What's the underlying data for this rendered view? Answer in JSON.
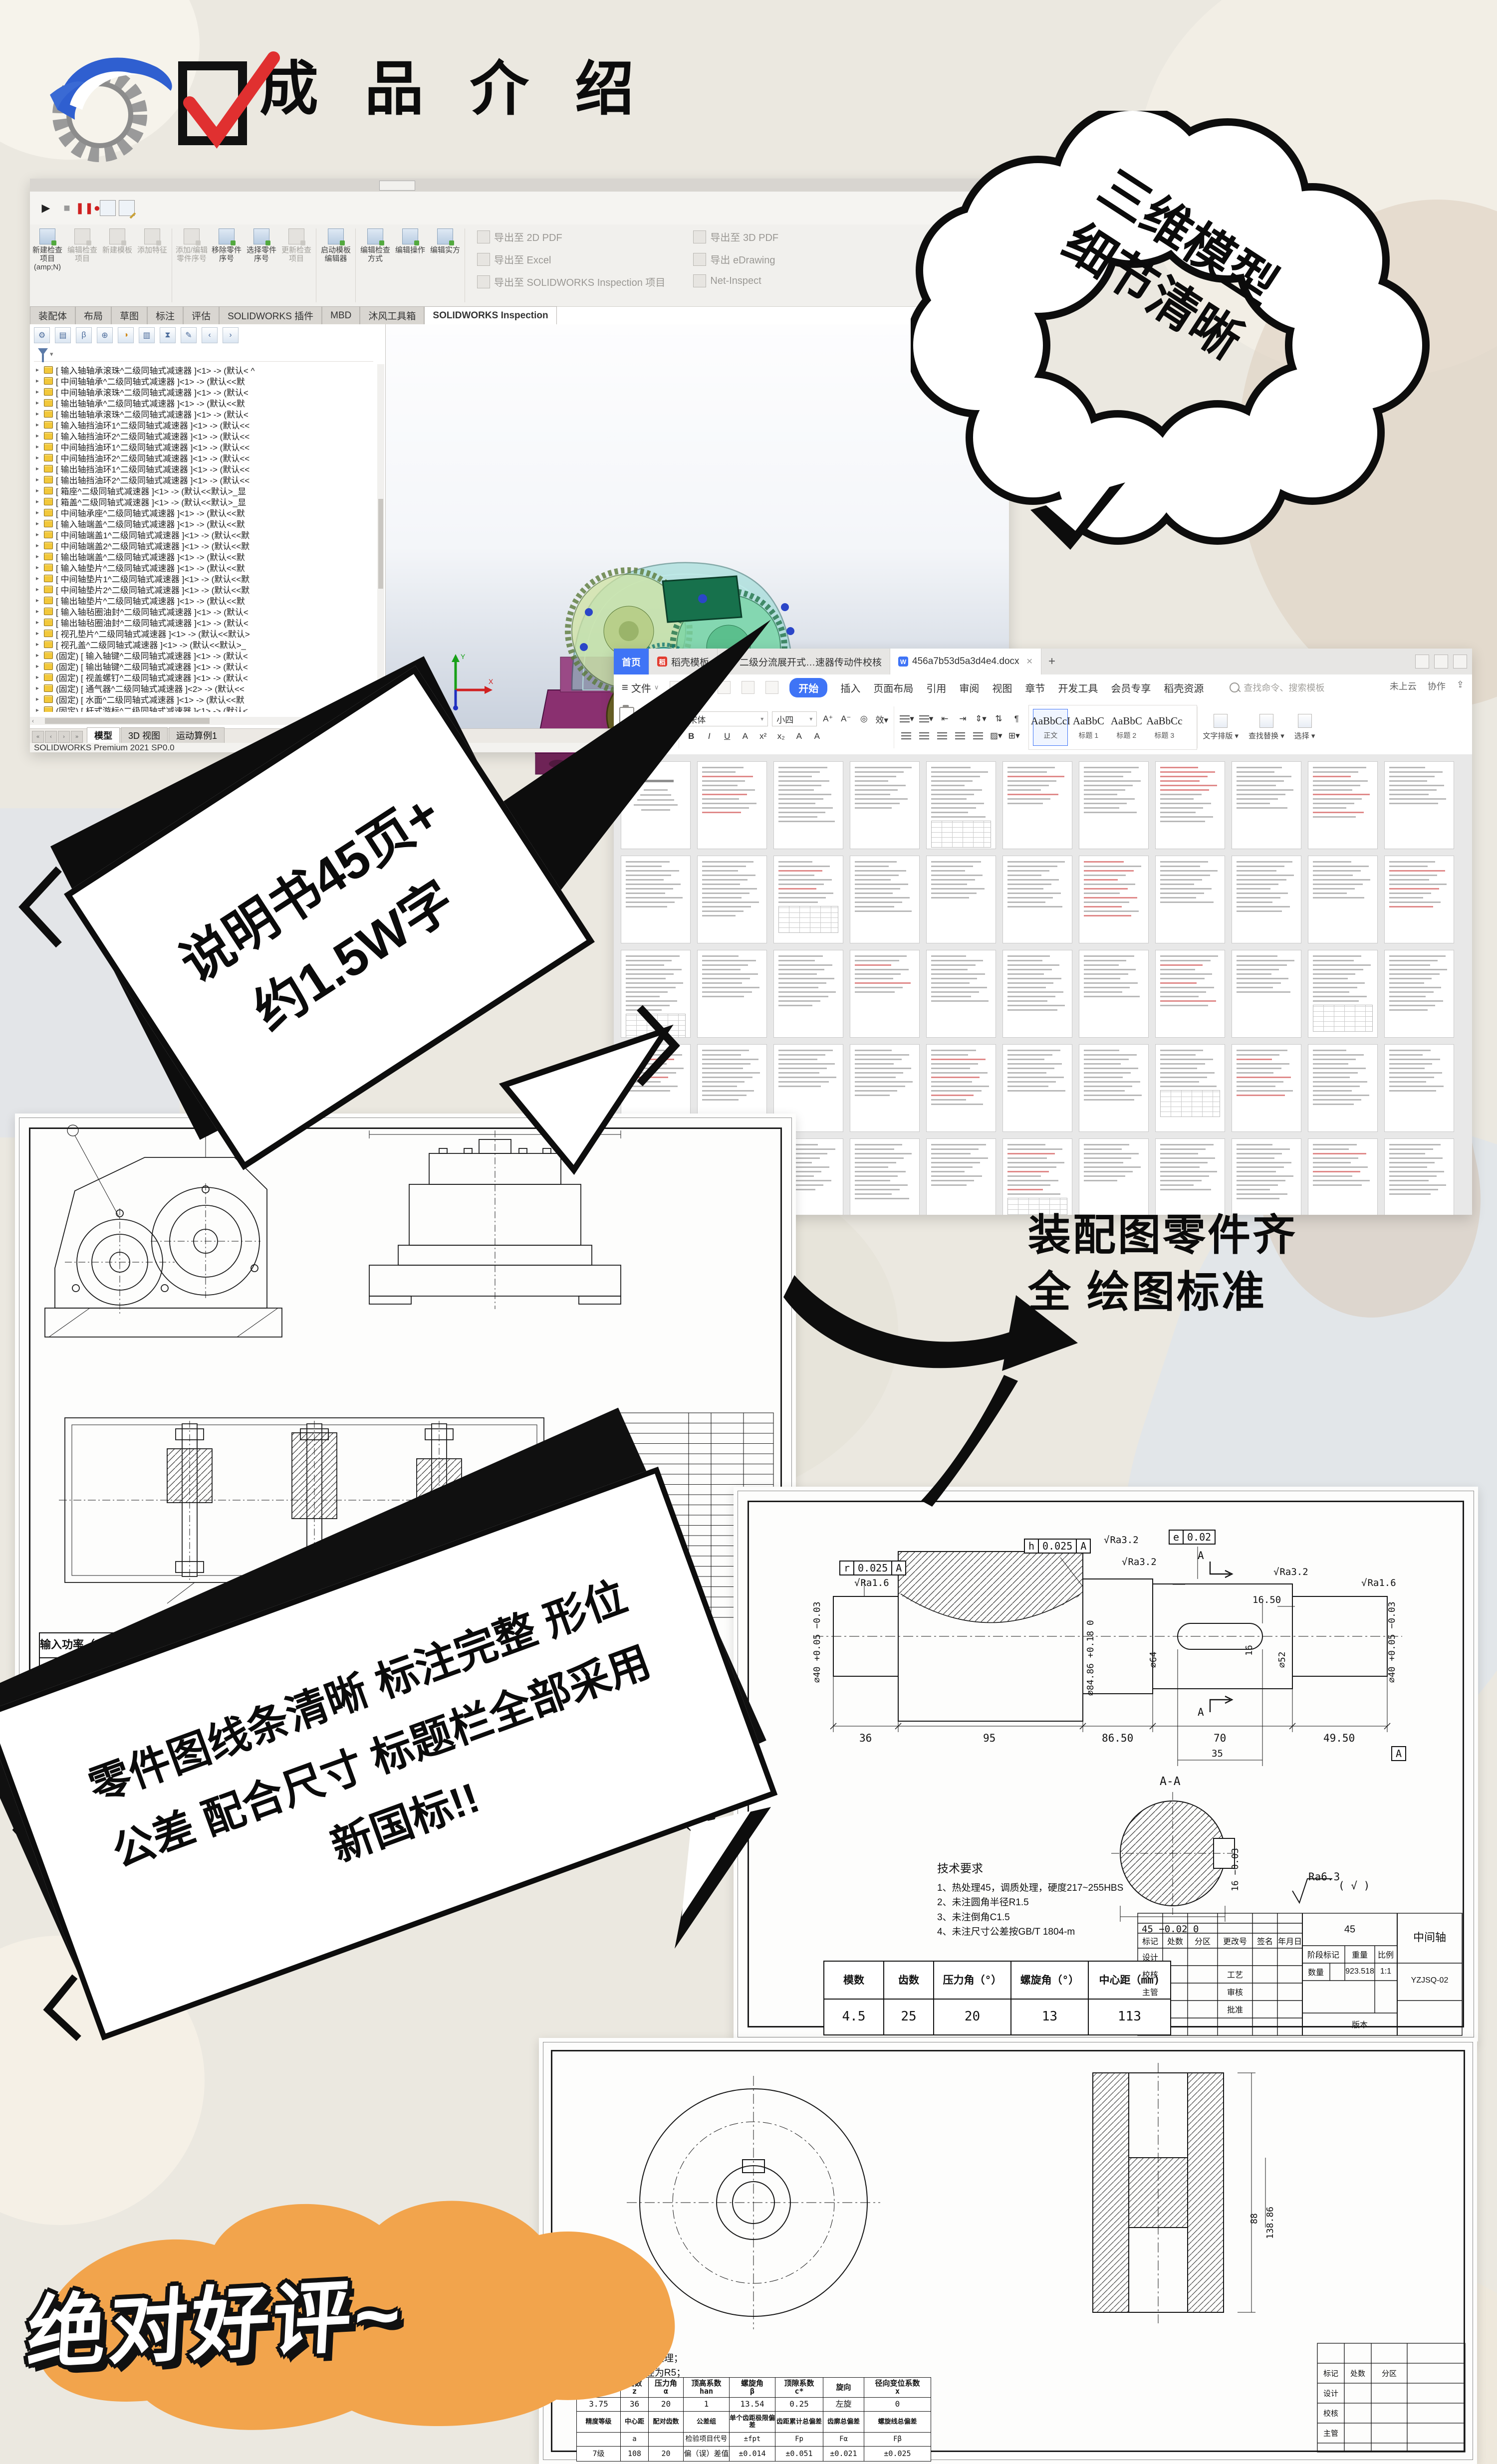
{
  "header": {
    "title": "成 品 介 绍",
    "logo_icon": "gear-swoosh-logo",
    "check_icon": "red-checkbox"
  },
  "callouts": {
    "cloud_line1": "三维模型",
    "cloud_line2": "细节清晰",
    "manual_line1": "说明书45页+",
    "manual_line2": "约1.5W字",
    "assembly_line1": "装配图零件齐",
    "assembly_line2": "全 绘图标准",
    "banner_line1": "零件图线条清晰 标注完整 形位",
    "banner_line2": "公差 配合尺寸 标题栏全部采用",
    "banner_line3": "新国标!!",
    "review": "绝对好评~",
    "accent_orange": "#f2a44c",
    "outline_black": "#0d0d0d"
  },
  "solidworks": {
    "ribbon_buttons": [
      "新建检查项目 (amp;N)",
      "编辑检查项目",
      "新建模板",
      "添加特征",
      "添加/编辑零件序号",
      "移除零件序号",
      "选择零件序号",
      "更新检查项目",
      "启动模板编辑器",
      "编辑检查方式",
      "编辑操作",
      "编辑实方"
    ],
    "disabled_buttons": [
      1,
      2,
      3,
      4,
      7
    ],
    "export_buttons": [
      "导出至 2D PDF",
      "导出至 Excel",
      "导出至 SOLIDWORKS Inspection 项目",
      "导出至 3D PDF",
      "导出 eDrawing",
      "Net-Inspect"
    ],
    "tabs": [
      "装配体",
      "布局",
      "草图",
      "标注",
      "评估",
      "SOLIDWORKS 插件",
      "MBD",
      "沐风工具箱",
      "SOLIDWORKS Inspection"
    ],
    "active_tab_index": 8,
    "tree_items": [
      "[ 输入轴轴承滚珠^二级同轴式减速器 ]<1> -> (默认<  ^",
      "[ 中间轴轴承^二级同轴式减速器 ]<1> -> (默认<<默",
      "[ 中间轴轴承滚珠^二级同轴式减速器 ]<1> -> (默认<",
      "[ 输出轴轴承^二级同轴式减速器 ]<1> -> (默认<<默",
      "[ 输出轴轴承滚珠^二级同轴式减速器 ]<1> -> (默认<",
      "[ 输入轴挡油环1^二级同轴式减速器 ]<1> -> (默认<<",
      "[ 输入轴挡油环2^二级同轴式减速器 ]<1> -> (默认<<",
      "[ 中间轴挡油环1^二级同轴式减速器 ]<1> -> (默认<<",
      "[ 中间轴挡油环2^二级同轴式减速器 ]<1> -> (默认<<",
      "[ 输出轴挡油环1^二级同轴式减速器 ]<1> -> (默认<<",
      "[ 输出轴挡油环2^二级同轴式减速器 ]<1> -> (默认<<",
      "[ 箱座^二级同轴式减速器 ]<1> -> (默认<<默认>_显",
      "[ 箱盖^二级同轴式减速器 ]<1> -> (默认<<默认>_显",
      "[ 中间轴承座^二级同轴式减速器 ]<1> -> (默认<<默",
      "[ 输入轴端盖^二级同轴式减速器 ]<1> -> (默认<<默",
      "[ 中间轴端盖1^二级同轴式减速器 ]<1> -> (默认<<默",
      "[ 中间轴端盖2^二级同轴式减速器 ]<1> -> (默认<<默",
      "[ 输出轴端盖^二级同轴式减速器 ]<1> -> (默认<<默",
      "[ 输入轴垫片^二级同轴式减速器 ]<1> -> (默认<<默",
      "[ 中间轴垫片1^二级同轴式减速器 ]<1> -> (默认<<默",
      "[ 中间轴垫片2^二级同轴式减速器 ]<1> -> (默认<<默",
      "[ 输出轴垫片^二级同轴式减速器 ]<1> -> (默认<<默",
      "[ 输入轴毡圈油封^二级同轴式减速器 ]<1> -> (默认<",
      "[ 输出轴毡圈油封^二级同轴式减速器 ]<1> -> (默认<",
      "[ 视孔垫片^二级同轴式减速器 ]<1> -> (默认<<默认>",
      "[ 视孔盖^二级同轴式减速器 ]<1> -> (默认<<默认>_",
      "(固定) [ 输入轴键^二级同轴式减速器 ]<1> -> (默认<",
      "(固定) [ 输出轴键^二级同轴式减速器 ]<1> -> (默认<",
      "(固定) [ 视盖螺钉^二级同轴式减速器 ]<1> -> (默认<",
      "(固定) [ 通气器^二级同轴式减速器 ]<2> -> (默认<<",
      "(固定) [ 水面^二级同轴式减速器 ]<1> -> (默认<<默",
      "(固定) [ 杆式游标^二级同轴式减速器 ]<1> -> (默认<",
      "(固定) [ 油圈^二级同轴式减速器 ]<1> -> (默认<<默"
    ],
    "bottom_tabs": [
      "模型",
      "3D 视图",
      "运动算例1"
    ],
    "active_bottom_tab_index": 0,
    "status": "SOLIDWORKS Premium 2021 SP0.0"
  },
  "wps": {
    "window_tabs": [
      {
        "label": "首页",
        "type": "home"
      },
      {
        "label": "稻壳模板",
        "type": "doc",
        "icon_color": "#e23c30",
        "icon_text": "稻"
      },
      {
        "label": "二级分流展开式…速器传动件校核",
        "type": "doc",
        "icon_color": "#ef7b1a",
        "icon_text": "P"
      },
      {
        "label": "456a7b53d5a3d4e4.docx",
        "type": "active",
        "icon_color": "#3f74f6",
        "icon_text": "W"
      }
    ],
    "new_tab": "+",
    "file_menu": "文件",
    "menus": [
      "开始",
      "插入",
      "页面布局",
      "引用",
      "审阅",
      "视图",
      "章节",
      "开发工具",
      "会员专享",
      "稻壳资源"
    ],
    "active_menu_index": 0,
    "search_placeholder": "查找命令、搜索模板",
    "cloud_status": "未上云",
    "collab": "协作",
    "clipboard": [
      "粘贴",
      "剪切",
      "复制",
      "格式刷"
    ],
    "font_name": "宋体",
    "font_size": "小四",
    "format_buttons": [
      "B",
      "I",
      "U",
      "A",
      "x²",
      "x₂",
      "A",
      "A"
    ],
    "styles": [
      {
        "sample": "AaBbCcI",
        "name": "正文"
      },
      {
        "sample": "AaBbC",
        "name": "标题 1"
      },
      {
        "sample": "AaBbC",
        "name": "标题 2"
      },
      {
        "sample": "AaBbCc",
        "name": "标题 3"
      }
    ],
    "tools": [
      "文字排版",
      "查找替换",
      "选择"
    ],
    "page_count_visible": 55
  },
  "assembly_sheet": {
    "tech_title": "技术要求",
    "spec_headers": [
      "输入功率（KW）",
      "输入转速（r/min)",
      "传动比"
    ],
    "spec_values": [
      "2.85",
      "177.5",
      "1.8"
    ],
    "detail_dim": "⌀30r6"
  },
  "shaft_sheet": {
    "gdt1": [
      "r",
      "0.025",
      "A"
    ],
    "gdt2": [
      "h",
      "0.025",
      "A"
    ],
    "gdt3": [
      "e",
      "0.02"
    ],
    "ra_left": "Ra1.6",
    "ra_mid1": "Ra3.2",
    "ra_mid2": "Ra3.2",
    "ra_mid3": "Ra3.2",
    "ra_right": "Ra1.6",
    "datum": "A",
    "len_dims": [
      "36",
      "95",
      "86.50",
      "70",
      "49.50"
    ],
    "dia_left": "⌀40 +0.05 −0.03",
    "dia_gear": "⌀84.86 +0.18 0",
    "dia_mid": "⌀64",
    "dia_key": "⌀52",
    "dia_right": "⌀40 +0.05 −0.03",
    "key_len": "16.50",
    "key_w": "16",
    "key_pos": "35",
    "section_label": "A-A",
    "section_dim_w": "45 −0.02 0",
    "section_dim_h": "16 −0.03",
    "finish_note": "Ra6.3",
    "finish_check": "( √ )",
    "tech": [
      "技术要求",
      "1、热处理45，调质处理，硬度217~255HBS",
      "2、未注圆角半径R1.5",
      "3、未注倒角C1.5",
      "4、未注尺寸公差按GB/T 1804-m"
    ],
    "param_headers": [
      "模数",
      "齿数",
      "压力角（°）",
      "螺旋角（°）",
      "中心距（mm)"
    ],
    "param_values": [
      "4.5",
      "25",
      "20",
      "13",
      "113"
    ],
    "title_block": {
      "row_labels": [
        "标记",
        "处数",
        "分区",
        "更改号",
        "签名",
        "年月日"
      ],
      "left_labels": [
        "设计",
        "校核",
        "主管"
      ],
      "mid_labels": [
        "工艺",
        "审核",
        "批准"
      ],
      "stage": "阶段标记",
      "weight": "重量",
      "scale": "比例",
      "qty": "数量",
      "version": "版本",
      "material": "45",
      "weight_val": "923.518",
      "scale_val": "1:1",
      "name": "中间轴",
      "code": "YZJSQ-02"
    }
  },
  "gear_sheet": {
    "tech": [
      "技术要求",
      "1.热处理，调质处理；",
      "2.未注圆角半径为R5；",
      "3.未注倒角为C2；",
      "4.清除毛刺。"
    ],
    "table_headers": [
      "法向模数\nm",
      "齿数\nz",
      "压力角\nα",
      "顶高系数\nhan",
      "螺旋角\nβ",
      "顶隙系数\nc*",
      "旋向",
      "径向变位系数\nx"
    ],
    "table_values": [
      "3.75",
      "36",
      "20",
      "1",
      "13.54",
      "0.25",
      "左旋",
      "0"
    ],
    "table2_headers": [
      "精度等级",
      "中心距",
      "配对齿数",
      "公差组",
      "单个齿距极限偏差",
      "齿距累计总偏差",
      "齿廓总偏差",
      "螺旋线总偏差"
    ],
    "table2_sub": [
      "",
      "a",
      "",
      "检验项目代号",
      "±fpt",
      "Fp",
      "Fα",
      "Fβ"
    ],
    "table2_values": [
      "7级",
      "108",
      "20",
      "偏（误）差值",
      "±0.014",
      "±0.051",
      "±0.021",
      "±0.025"
    ],
    "dim_a": "88",
    "dim_b": "138.86",
    "tb_labels": [
      "标记",
      "处数",
      "分区",
      "设计",
      "校核",
      "主管"
    ]
  }
}
